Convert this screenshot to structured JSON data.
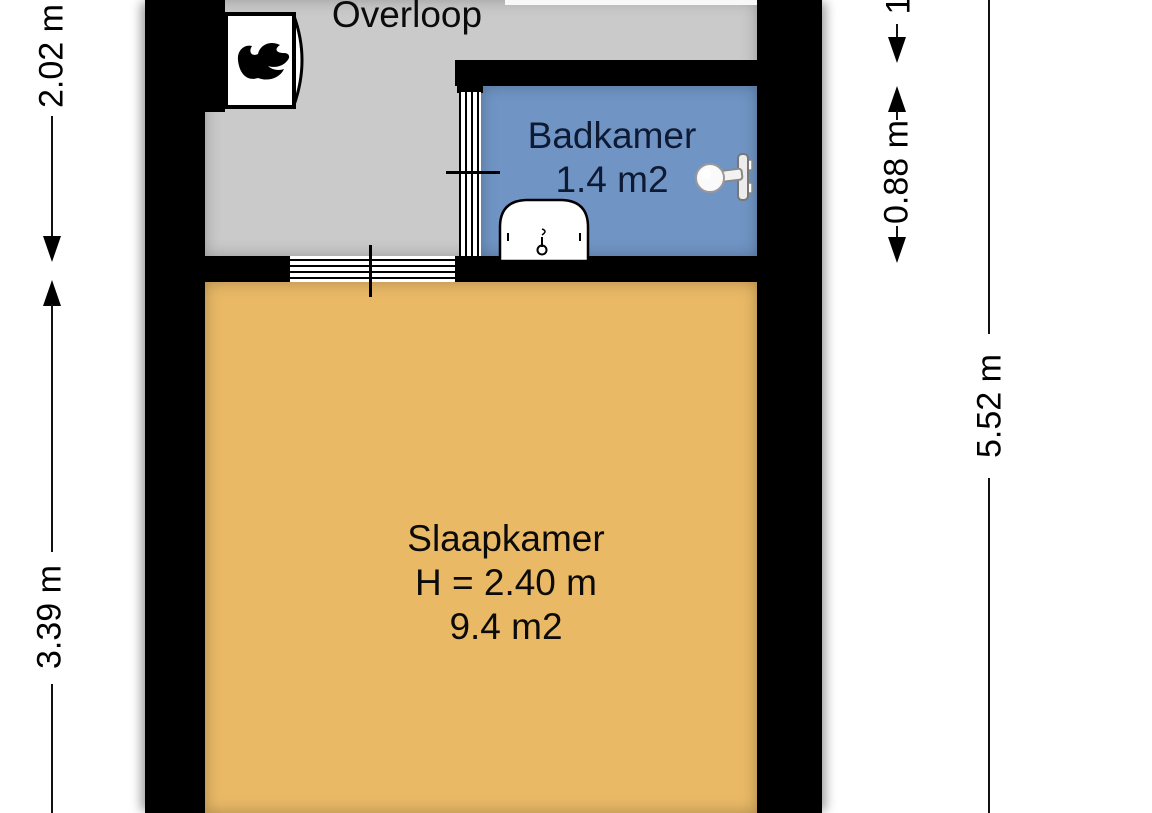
{
  "plan_type": "floor-plan",
  "rooms": {
    "overloop": {
      "label": "Overloop"
    },
    "badkamer": {
      "label": "Badkamer",
      "area": "1.4 m2"
    },
    "slaapkamer": {
      "label": "Slaapkamer",
      "ceiling_height": "H = 2.40 m",
      "area": "9.4 m2"
    }
  },
  "dimensions": {
    "left_top": "2.02 m",
    "left_bottom": "3.39 m",
    "right_partial": "1",
    "right_badkamer": "0.88 m",
    "right_total": "5.52 m"
  },
  "icons": {
    "boiler": "boiler-flame-icon",
    "sink": "sink-icon",
    "shower": "shower-head-icon"
  },
  "colors": {
    "wall": "#000000",
    "overloop_floor": "#CACACA",
    "badkamer_floor": "#7095C5",
    "slaapkamer_floor": "#E9B966",
    "background": "#FFFFFF",
    "badkamer_text": "#0e1a33"
  }
}
